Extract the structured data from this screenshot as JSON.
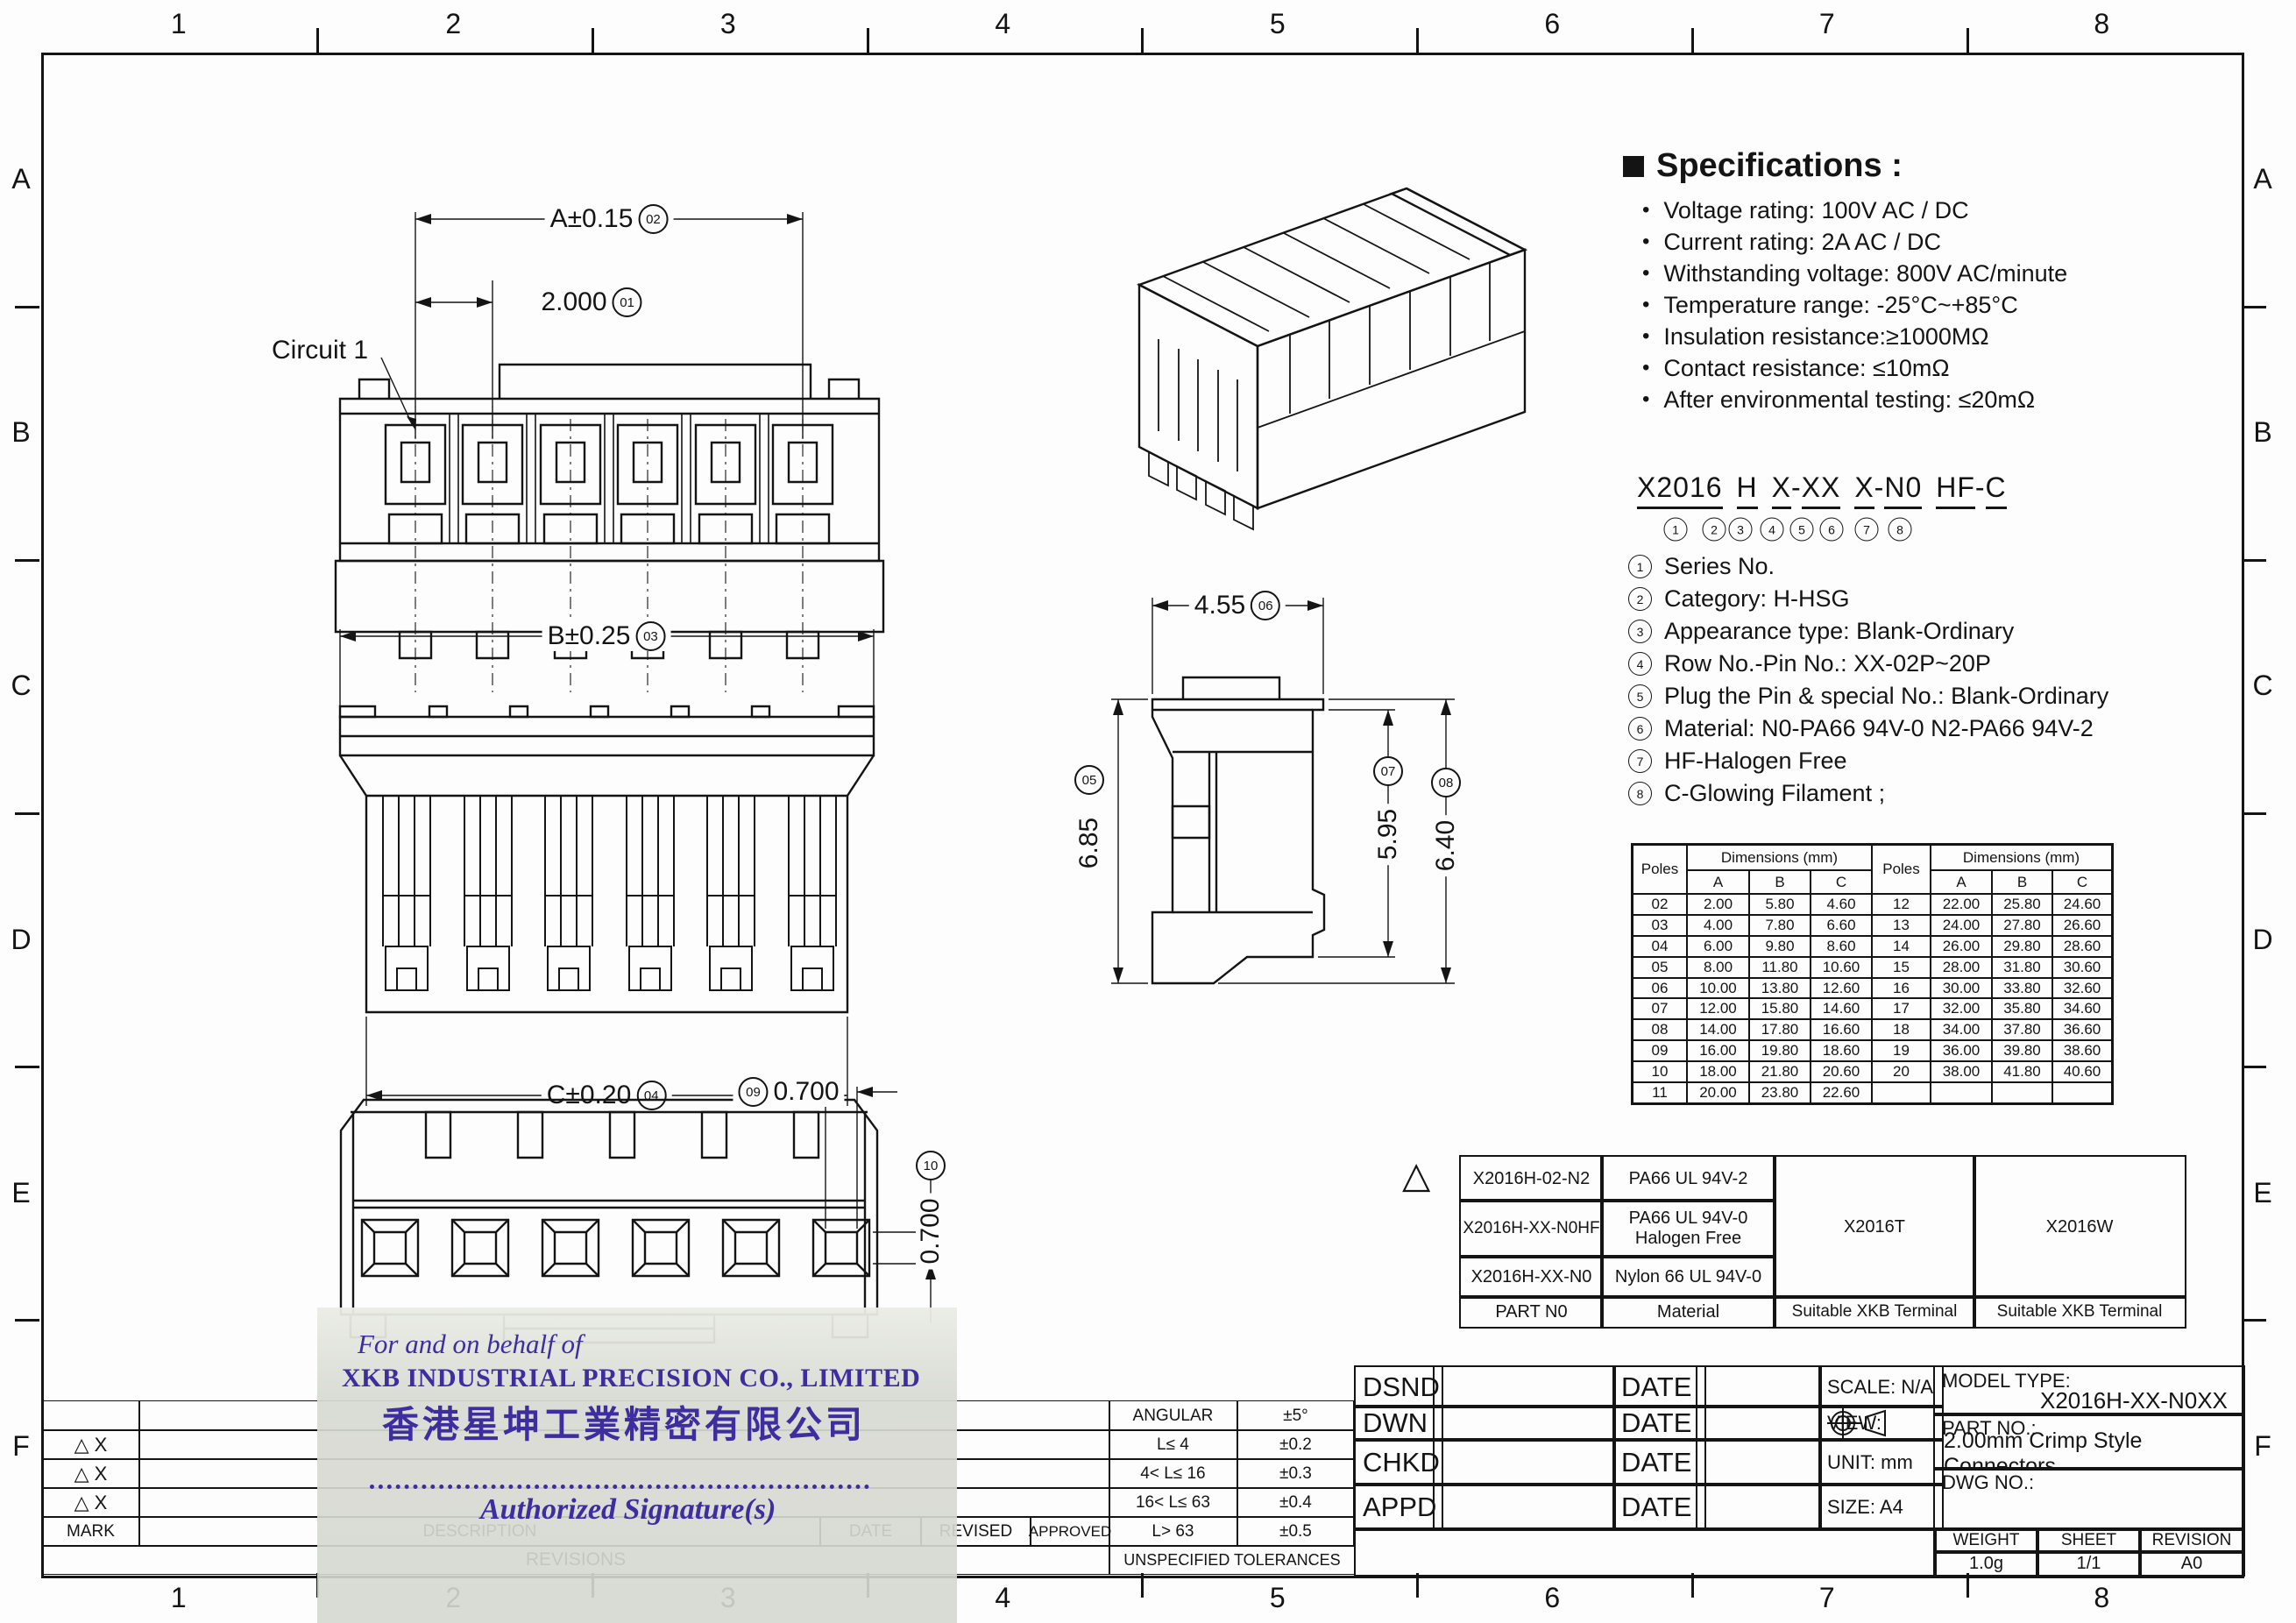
{
  "frame": {
    "cols": [
      "1",
      "2",
      "3",
      "4",
      "5",
      "6",
      "7",
      "8"
    ],
    "rows": [
      "A",
      "B",
      "C",
      "D",
      "E",
      "F"
    ]
  },
  "specs": {
    "title": "Specifications :",
    "bullet": "•",
    "items": [
      "Voltage rating: 100V AC / DC",
      "Current rating:  2A  AC / DC",
      "Withstanding voltage: 800V AC/minute",
      "Temperature range: -25°C~+85°C",
      "Insulation resistance:≥1000MΩ",
      "Contact resistance: ≤10mΩ",
      "After environmental testing:  ≤20mΩ"
    ]
  },
  "part_code": {
    "parts": [
      "X2016",
      "H",
      "X",
      "-",
      "XX",
      "X",
      "-",
      "N0",
      "HF",
      "-",
      "C"
    ],
    "refs": [
      "1",
      "2",
      "3",
      "4",
      "5",
      "6",
      "7",
      "8"
    ],
    "legend": [
      {
        "n": "1",
        "t": "Series No."
      },
      {
        "n": "2",
        "t": "Category: H-HSG"
      },
      {
        "n": "3",
        "t": "Appearance type: Blank-Ordinary"
      },
      {
        "n": "4",
        "t": "Row No.-Pin No.:  XX-02P~20P"
      },
      {
        "n": "5",
        "t": "Plug the Pin & special No.: Blank-Ordinary"
      },
      {
        "n": "6",
        "t": "Material: N0-PA66 94V-0   N2-PA66 94V-2"
      },
      {
        "n": "7",
        "t": "HF-Halogen Free"
      },
      {
        "n": "8",
        "t": "C-Glowing Filament ;"
      }
    ]
  },
  "dim_table": {
    "poles_label": "Poles",
    "dims_label": "Dimensions (mm)",
    "col_a": "A",
    "col_b": "B",
    "col_c": "C",
    "rows": [
      [
        "02",
        "2.00",
        "5.80",
        "4.60",
        "12",
        "22.00",
        "25.80",
        "24.60"
      ],
      [
        "03",
        "4.00",
        "7.80",
        "6.60",
        "13",
        "24.00",
        "27.80",
        "26.60"
      ],
      [
        "04",
        "6.00",
        "9.80",
        "8.60",
        "14",
        "26.00",
        "29.80",
        "28.60"
      ],
      [
        "05",
        "8.00",
        "11.80",
        "10.60",
        "15",
        "28.00",
        "31.80",
        "30.60"
      ],
      [
        "06",
        "10.00",
        "13.80",
        "12.60",
        "16",
        "30.00",
        "33.80",
        "32.60"
      ],
      [
        "07",
        "12.00",
        "15.80",
        "14.60",
        "17",
        "32.00",
        "35.80",
        "34.60"
      ],
      [
        "08",
        "14.00",
        "17.80",
        "16.60",
        "18",
        "34.00",
        "37.80",
        "36.60"
      ],
      [
        "09",
        "16.00",
        "19.80",
        "18.60",
        "19",
        "36.00",
        "39.80",
        "38.60"
      ],
      [
        "10",
        "18.00",
        "21.80",
        "20.60",
        "20",
        "38.00",
        "41.80",
        "40.60"
      ],
      [
        "11",
        "20.00",
        "23.80",
        "22.60",
        "",
        "",
        "",
        ""
      ]
    ]
  },
  "material_table": {
    "mark": "△",
    "r1c1": "X2016H-02-N2",
    "r1c2": "PA66 UL 94V-2",
    "r2c1": "X2016H-XX-N0HF",
    "r2c2": "PA66  UL 94V-0\nHalogen Free",
    "r3c1": "X2016H-XX-N0",
    "r3c2": "Nylon 66  UL 94V-0",
    "terminal1": "X2016T",
    "terminal2": "X2016W",
    "f1": "PART N0",
    "f2": "Material",
    "f3": "Suitable XKB Terminal",
    "f4": "Suitable XKB Terminal"
  },
  "title_block": {
    "roles": [
      {
        "role": "DSND",
        "date": "DATE"
      },
      {
        "role": "DWN",
        "date": "DATE"
      },
      {
        "role": "CHKD",
        "date": "DATE"
      },
      {
        "role": "APPD",
        "date": "DATE"
      }
    ],
    "scale": "SCALE: N/A",
    "view_label": "VIEW:",
    "unit": "UNIT:  mm",
    "size": "SIZE:  A4",
    "model_type_label": "MODEL TYPE:",
    "model_type": "X2016H-XX-N0XX",
    "part_no_label": "PART NO.:",
    "part_no": "2.00mm Crimp Style Connectors",
    "dwg_no_label": "DWG NO.:",
    "weight_label": "WEIGHT",
    "weight": "1.0g",
    "sheet_label": "SHEET",
    "sheet": "1/1",
    "revision_label": "REVISION",
    "revision": "A0"
  },
  "revisions": {
    "mark_rows": [
      "△ X",
      "△ X",
      "△ X"
    ],
    "mark_header": "MARK",
    "description": "DESCRIPTION",
    "date": "DATE",
    "revised": "REVISED",
    "approved": "APPROVED",
    "title": "REVISIONS"
  },
  "tolerances": {
    "rows": [
      [
        "ANGULAR",
        "±5°"
      ],
      [
        "L≤ 4",
        "±0.2"
      ],
      [
        "4< L≤ 16",
        "±0.3"
      ],
      [
        "16< L≤ 63",
        "±0.4"
      ],
      [
        "L> 63",
        "±0.5"
      ]
    ],
    "footer": "UNSPECIFIED  TOLERANCES"
  },
  "stamp": {
    "line1": "For and on behalf of",
    "line2": "XKB INDUSTRIAL PRECISION CO., LIMITED",
    "line3": "香港星坤工業精密有限公司",
    "line4": "Authorized Signature(s)"
  },
  "views": {
    "front": {
      "dim_a": "A±0.15",
      "ref_a": "02",
      "dim_pitch": "2.000",
      "ref_pitch": "01",
      "circuit": "Circuit 1"
    },
    "bottom": {
      "dim_b": "B±0.25",
      "ref_b": "03",
      "dim_c": "C±0.20",
      "ref_c": "04"
    },
    "side": {
      "dim_w": "4.55",
      "ref_w": "06",
      "dim_h": "6.85",
      "ref_h": "05",
      "dim_h2": "5.95",
      "ref_h2": "07",
      "dim_h3": "6.40",
      "ref_h3": "08"
    },
    "rear": {
      "dim_p": "0.700",
      "ref_p": "09",
      "dim_v": "0.700",
      "ref_v": "10"
    }
  }
}
